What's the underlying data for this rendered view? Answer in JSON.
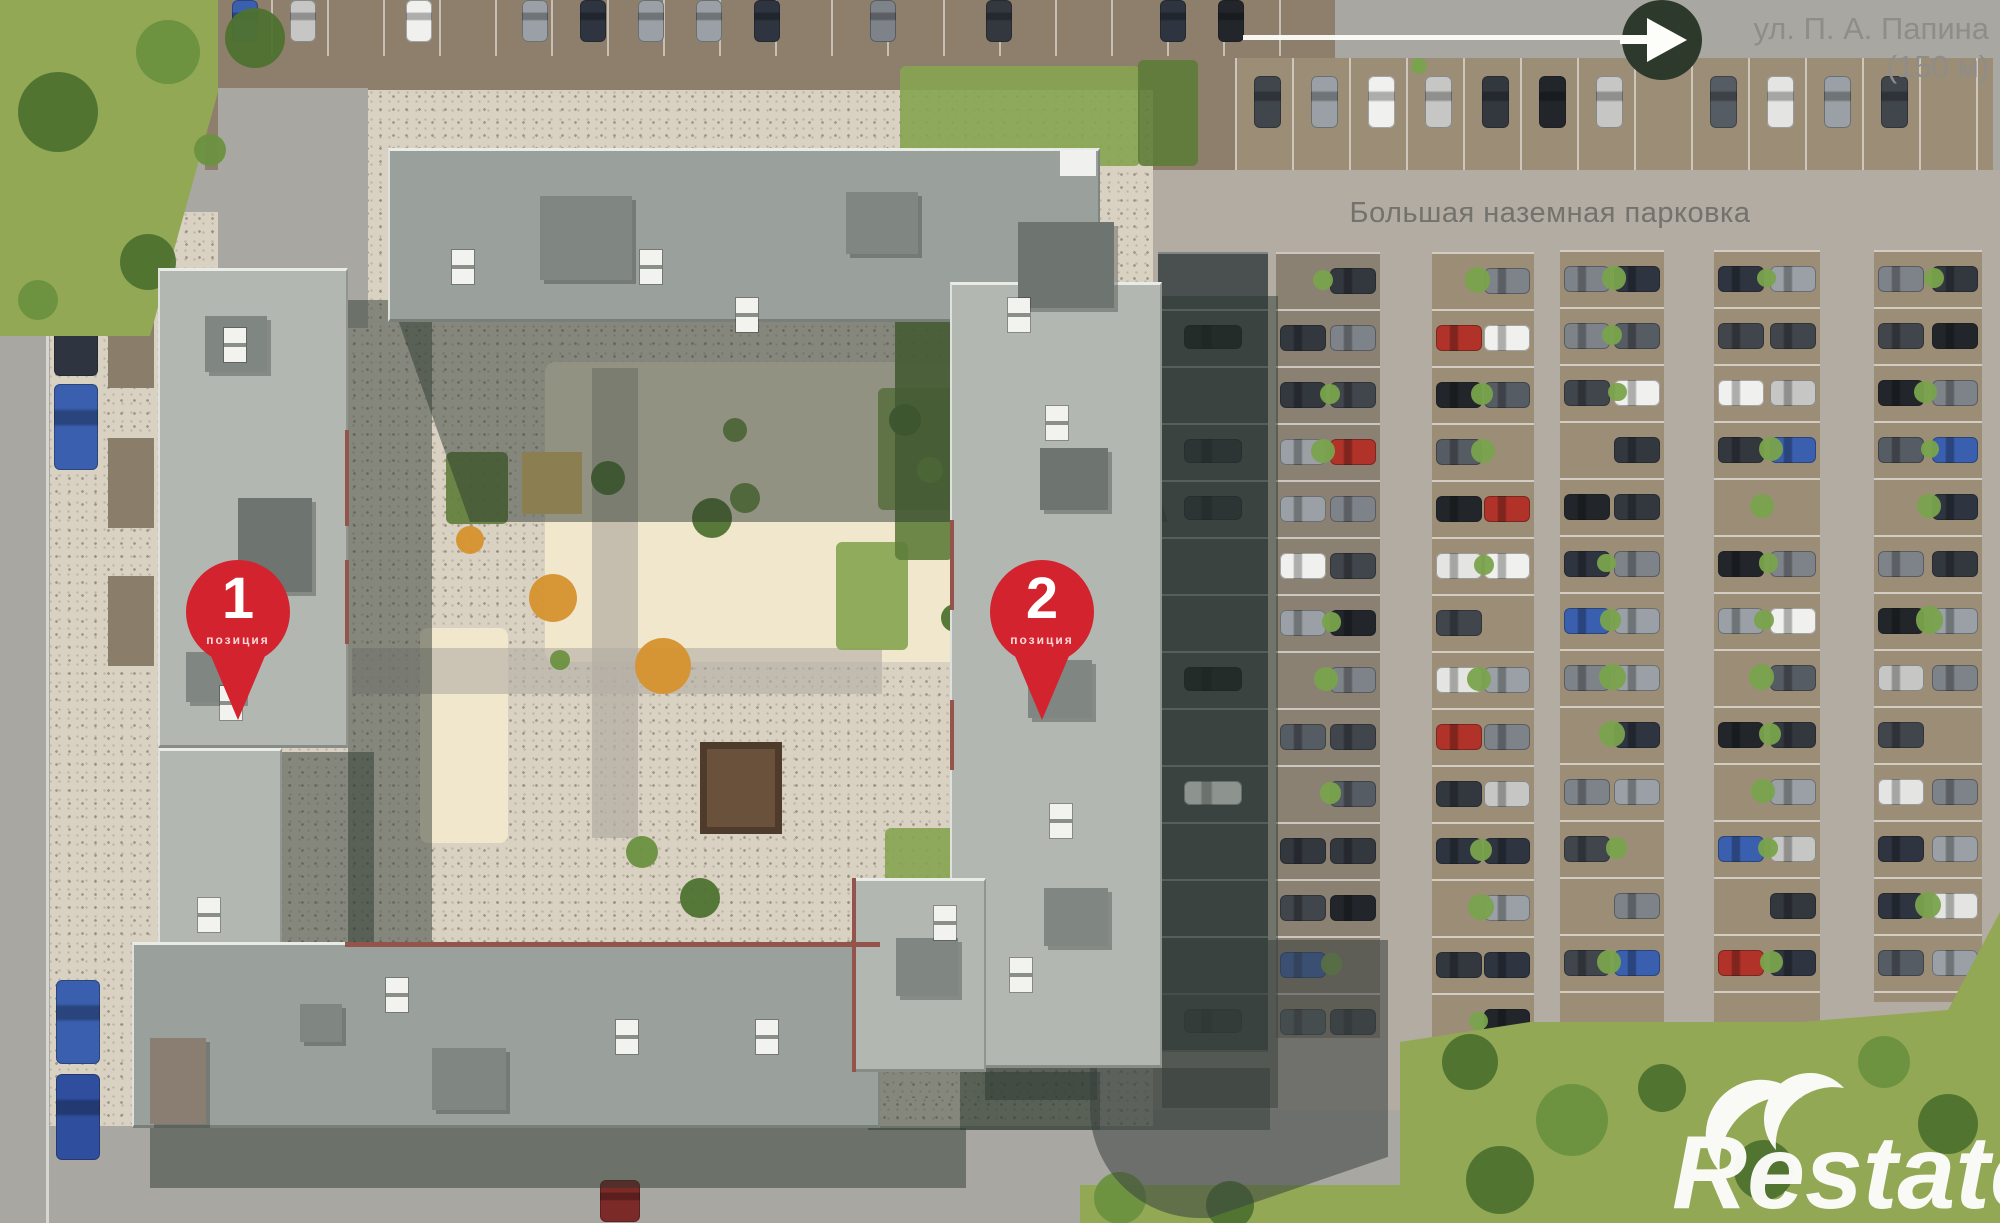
{
  "annotations": {
    "street": {
      "line1": "ул. П. А. Папина",
      "line2": "(150 м)"
    },
    "parking_label": "Большая наземная парковка",
    "pins": [
      {
        "number": "1",
        "caption": "позиция"
      },
      {
        "number": "2",
        "caption": "позиция"
      }
    ],
    "watermark": "Restate"
  },
  "colors": {
    "asphalt": "#a9a7a2",
    "lane": "#b2aca3",
    "lot_brown": "#8d7f6c",
    "strip_brown": "#9c8d77",
    "strip_shade": "#8b8173",
    "dark_strip": "#49504f",
    "paving": "#d9d2c3",
    "grass": "#92a854",
    "bed": "#86a451",
    "bed_dark": "#5d7c38",
    "tree": "#4e722f",
    "tree_light": "#6c9140",
    "tree_orange": "#d6922e",
    "bush": "#79a34c",
    "roof_a": "#9aa09b",
    "roof_b": "#b3b7b2",
    "roof_box": "#808682",
    "roof_box_dark": "#6e746f",
    "roof_box_warm": "#8a7e72",
    "trim_red": "#95544b",
    "shadow": "#2a362e",
    "cream": "#f0e7cd",
    "sand": "#e5c06f",
    "pergola": "#6a513c",
    "pin_red": "#d2232e",
    "street_text": "#8e8d89",
    "parking_text": "#73726c",
    "arrow_circle": "#2d3a2b",
    "marking_white": "#fdfdfa",
    "car_palette": [
      "#33383f",
      "#f0f0ee",
      "#22262b",
      "#c6c7c5",
      "#565c63",
      "#b13229",
      "#3a5fae",
      "#7e8389",
      "#41464d",
      "#e4e5e3",
      "#2e3440",
      "#9aa0a5"
    ]
  }
}
